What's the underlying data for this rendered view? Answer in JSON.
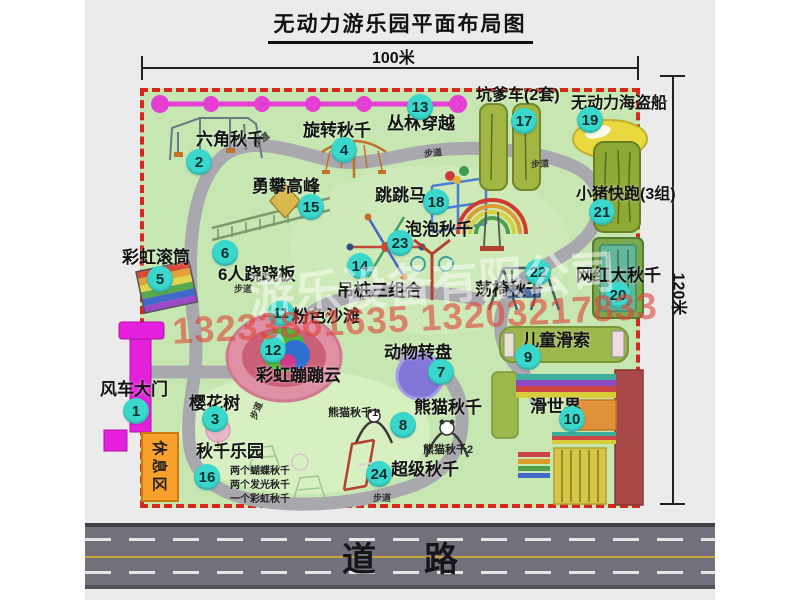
{
  "title": "无动力游乐园平面布局图",
  "dims": {
    "top": "100米",
    "right": "120米"
  },
  "road": {
    "label": "道路"
  },
  "watermark": {
    "company": "游乐设备有限公司",
    "phone": "13233861635 13203217833"
  },
  "colors": {
    "map_bg": "#c6e7b2",
    "map_border": "#d6281e",
    "badge": "#3ad8cc",
    "road": "#71717b",
    "road_yellow": "#c9a23a",
    "gate_magenta": "#e520dc",
    "rest_area_orange": "#f7a02c",
    "jungle_line_pink": "#e63fd4"
  },
  "map": {
    "rest_area_label": "休息区",
    "path_label_text": "步道",
    "path_labels": [
      {
        "x": 252,
        "y": 133,
        "rot": -38
      },
      {
        "x": 424,
        "y": 146,
        "rot": -6
      },
      {
        "x": 531,
        "y": 157,
        "rot": -4
      },
      {
        "x": 234,
        "y": 282,
        "rot": 0
      },
      {
        "x": 247,
        "y": 404,
        "rot": -68
      },
      {
        "x": 373,
        "y": 491,
        "rot": 0
      }
    ],
    "attractions": [
      {
        "num": 1,
        "name": "风车大门",
        "nx": 136,
        "ny": 411,
        "lx": 100,
        "ly": 381
      },
      {
        "num": 2,
        "name": "六角秋千",
        "nx": 199,
        "ny": 162,
        "lx": 196,
        "ly": 131
      },
      {
        "num": 3,
        "name": "樱花树",
        "nx": 215,
        "ny": 419,
        "lx": 189,
        "ly": 395
      },
      {
        "num": 4,
        "name": "旋转秋千",
        "nx": 344,
        "ny": 150,
        "lx": 303,
        "ly": 122
      },
      {
        "num": 5,
        "name": "彩虹滚筒",
        "nx": 160,
        "ny": 279,
        "lx": 122,
        "ly": 249
      },
      {
        "num": 6,
        "name": "6人跷跷板",
        "nx": 225,
        "ny": 253,
        "lx": 218,
        "ly": 266
      },
      {
        "num": 7,
        "name": "动物转盘",
        "nx": 441,
        "ny": 372,
        "lx": 384,
        "ly": 344
      },
      {
        "num": 8,
        "name": "熊猫秋千",
        "nx": 403,
        "ny": 425,
        "lx": 414,
        "ly": 399
      },
      {
        "num": 9,
        "name": "儿童滑索",
        "nx": 528,
        "ny": 357,
        "lx": 522,
        "ly": 332
      },
      {
        "num": 10,
        "name": "滑世界",
        "nx": 572,
        "ny": 419,
        "lx": 530,
        "ly": 398
      },
      {
        "num": 11,
        "name": "粉色沙滩",
        "nx": 281,
        "ny": 313,
        "lx": 292,
        "ly": 308
      },
      {
        "num": 12,
        "name": "彩虹蹦蹦云",
        "nx": 273,
        "ny": 350,
        "lx": 256,
        "ly": 367
      },
      {
        "num": 13,
        "name": "丛林穿越",
        "nx": 420,
        "ny": 107,
        "lx": 387,
        "ly": 115
      },
      {
        "num": 14,
        "name": "吊桩三组合",
        "nx": 360,
        "ny": 266,
        "lx": 337,
        "ly": 282
      },
      {
        "num": 15,
        "name": "勇攀高峰",
        "nx": 311,
        "ny": 207,
        "lx": 252,
        "ly": 178
      },
      {
        "num": 16,
        "name": "秋千乐园",
        "nx": 207,
        "ny": 477,
        "lx": 196,
        "ly": 443
      },
      {
        "num": 17,
        "name": "坑爹车(2套)",
        "nx": 524,
        "ny": 121,
        "lx": 476,
        "ly": 87,
        "fs": 16
      },
      {
        "num": 18,
        "name": "跳跳马",
        "nx": 436,
        "ny": 202,
        "lx": 375,
        "ly": 187
      },
      {
        "num": 19,
        "name": "无动力海盗船",
        "nx": 590,
        "ny": 120,
        "lx": 571,
        "ly": 95,
        "fs": 16
      },
      {
        "num": 20,
        "name": "网红大秋千",
        "nx": 618,
        "ny": 295,
        "lx": 576,
        "ly": 267
      },
      {
        "num": 21,
        "name": "小猪快跑(3组)",
        "nx": 602,
        "ny": 212,
        "lx": 576,
        "ly": 186,
        "fs": 16
      },
      {
        "num": 22,
        "name": "荡椅秋千",
        "nx": 538,
        "ny": 272,
        "lx": 475,
        "ly": 281
      },
      {
        "num": 23,
        "name": "泡泡秋千",
        "nx": 400,
        "ny": 243,
        "lx": 405,
        "ly": 221
      },
      {
        "num": 24,
        "name": "超级秋千",
        "nx": 379,
        "ny": 474,
        "lx": 391,
        "ly": 461
      }
    ],
    "sublabels": [
      {
        "text": "熊猫秋千1",
        "x": 328,
        "y": 404,
        "fs": 11
      },
      {
        "text": "熊猫秋千2",
        "x": 423,
        "y": 441,
        "fs": 11
      },
      {
        "text": "两个蝴蝶秋千",
        "x": 230,
        "y": 462,
        "fs": 10
      },
      {
        "text": "两个发光秋千",
        "x": 230,
        "y": 476,
        "fs": 10
      },
      {
        "text": "一个彩虹秋千",
        "x": 230,
        "y": 490,
        "fs": 10
      }
    ]
  },
  "icons": [
    "windmill-gate-icon",
    "jungle-crossing-line-icon",
    "hex-swing-icon",
    "rotating-swing-icon",
    "climbing-peak-icon",
    "rainbow-roller-icon",
    "seesaw-icon",
    "jumping-horse-icon",
    "rainbow-swing-icon",
    "bubble-swing-icon",
    "pit-cars-icon",
    "pirate-ship-icon",
    "pig-run-icon",
    "big-swing-icon",
    "zipline-icon",
    "slide-world-icon",
    "chair-swing-icon",
    "pink-beach-icon",
    "bouncy-cloud-icon",
    "animal-turntable-icon",
    "panda-swing-icon",
    "super-swing-icon",
    "cherry-tree-icon"
  ]
}
